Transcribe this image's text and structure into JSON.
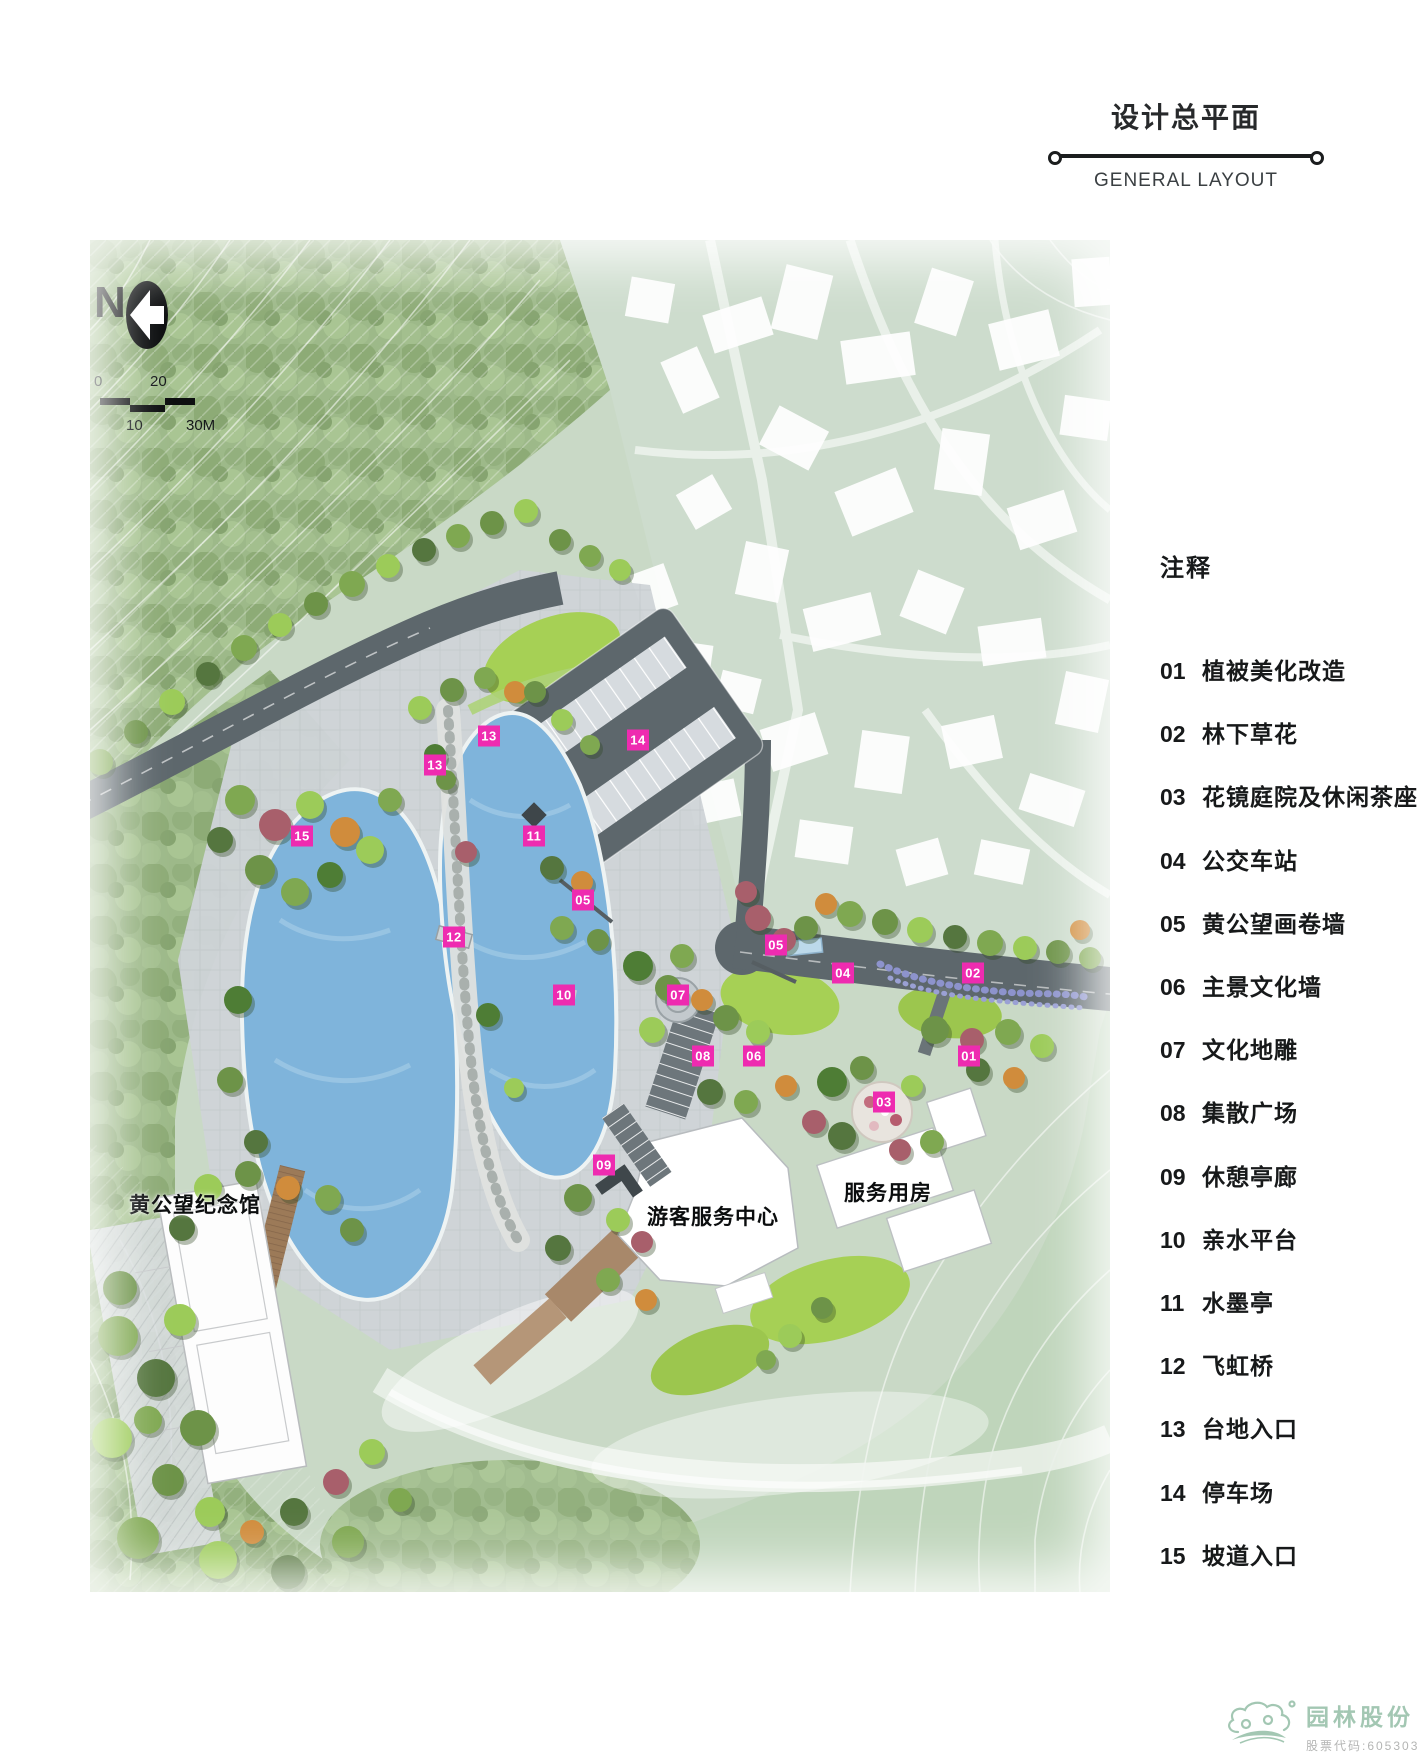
{
  "header": {
    "title": "设计总平面",
    "subtitle": "GENERAL LAYOUT"
  },
  "legend": {
    "heading": "注释",
    "items": [
      {
        "num": "01",
        "label": "植被美化改造"
      },
      {
        "num": "02",
        "label": "林下草花"
      },
      {
        "num": "03",
        "label": "花镜庭院及休闲茶座"
      },
      {
        "num": "04",
        "label": "公交车站"
      },
      {
        "num": "05",
        "label": "黄公望画卷墙"
      },
      {
        "num": "06",
        "label": "主景文化墙"
      },
      {
        "num": "07",
        "label": "文化地雕"
      },
      {
        "num": "08",
        "label": "集散广场"
      },
      {
        "num": "09",
        "label": "休憩亭廊"
      },
      {
        "num": "10",
        "label": "亲水平台"
      },
      {
        "num": "11",
        "label": "水墨亭"
      },
      {
        "num": "12",
        "label": "飞虹桥"
      },
      {
        "num": "13",
        "label": "台地入口"
      },
      {
        "num": "14",
        "label": "停车场"
      },
      {
        "num": "15",
        "label": "坡道入口"
      }
    ]
  },
  "map": {
    "north_label": "N",
    "scale_labels": {
      "zero": "0",
      "twenty": "20",
      "ten": "10",
      "thirty": "30M"
    },
    "place_labels": [
      {
        "text": "黄公望纪念馆",
        "x": 105,
        "y": 964
      },
      {
        "text": "游客服务中心",
        "x": 623,
        "y": 976
      },
      {
        "text": "服务用房",
        "x": 798,
        "y": 952
      }
    ],
    "markers": [
      {
        "num": "13",
        "x": 399,
        "y": 496
      },
      {
        "num": "14",
        "x": 548,
        "y": 500
      },
      {
        "num": "13",
        "x": 345,
        "y": 525
      },
      {
        "num": "11",
        "x": 444,
        "y": 596
      },
      {
        "num": "15",
        "x": 212,
        "y": 596
      },
      {
        "num": "05",
        "x": 493,
        "y": 660
      },
      {
        "num": "12",
        "x": 364,
        "y": 697
      },
      {
        "num": "05",
        "x": 686,
        "y": 705
      },
      {
        "num": "04",
        "x": 753,
        "y": 733
      },
      {
        "num": "02",
        "x": 883,
        "y": 733
      },
      {
        "num": "10",
        "x": 474,
        "y": 755
      },
      {
        "num": "07",
        "x": 588,
        "y": 755
      },
      {
        "num": "08",
        "x": 613,
        "y": 816
      },
      {
        "num": "06",
        "x": 664,
        "y": 816
      },
      {
        "num": "01",
        "x": 879,
        "y": 816
      },
      {
        "num": "03",
        "x": 794,
        "y": 862
      },
      {
        "num": "09",
        "x": 514,
        "y": 925
      }
    ],
    "marker_color": "#ee2bb0"
  },
  "logo": {
    "company": "园林股份",
    "stock_code": "股票代码:605303",
    "color": "#a3c7b3"
  }
}
